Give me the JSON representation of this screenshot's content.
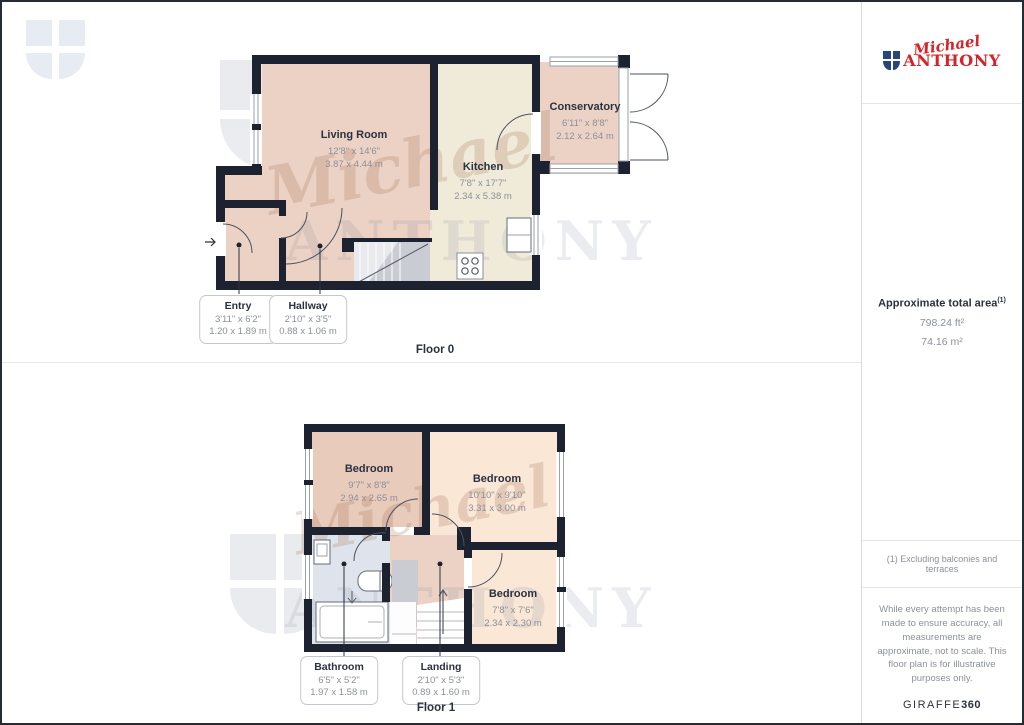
{
  "brand": {
    "script": "Michael",
    "caps": "ANTHONY"
  },
  "floors": [
    {
      "label": "Floor 0",
      "rooms": [
        {
          "name": "Living Room",
          "imperial": "12'8\" x 14'6\"",
          "metric": "3.87 x 4.44 m"
        },
        {
          "name": "Kitchen",
          "imperial": "7'8\" x 17'7\"",
          "metric": "2.34 x 5.38 m"
        },
        {
          "name": "Conservatory",
          "imperial": "6'11\" x 8'8\"",
          "metric": "2.12 x 2.64 m"
        }
      ],
      "callouts": [
        {
          "name": "Entry",
          "imperial": "3'11\" x 6'2\"",
          "metric": "1.20 x 1.89 m"
        },
        {
          "name": "Hallway",
          "imperial": "2'10\" x 3'5\"",
          "metric": "0.88 x 1.06 m"
        }
      ]
    },
    {
      "label": "Floor 1",
      "rooms": [
        {
          "name": "Bedroom",
          "imperial": "9'7\" x 8'8\"",
          "metric": "2.94 x 2.65 m"
        },
        {
          "name": "Bedroom",
          "imperial": "10'10\" x 9'10\"",
          "metric": "3.31 x 3.00 m"
        },
        {
          "name": "Bedroom",
          "imperial": "7'8\" x 7'6\"",
          "metric": "2.34 x 2.30 m"
        }
      ],
      "callouts": [
        {
          "name": "Bathroom",
          "imperial": "6'5\" x 5'2\"",
          "metric": "1.97 x 1.58 m"
        },
        {
          "name": "Landing",
          "imperial": "2'10\" x 5'3\"",
          "metric": "0.89 x 1.60 m"
        }
      ]
    }
  ],
  "sidebar": {
    "area_title": "Approximate total area",
    "area_sup": "(1)",
    "area_ft": "798.24 ft²",
    "area_m": "74.16 m²",
    "footnote": "(1) Excluding balconies and terraces",
    "disclaimer": "While every attempt has been made to ensure accuracy, all measurements are approximate, not to scale. This floor plan is for illustrative purposes only.",
    "provider": "GIRAFFE",
    "provider_suffix": "360"
  },
  "colors": {
    "wall": "#1d2230",
    "room_pink": "#ecd2c4",
    "room_cream": "#f0ead9",
    "room_peach": "#fae7d6",
    "room_warm": "#e9cbbb",
    "room_bath": "#dfe4ec",
    "stairs_gray": "#c9ccd3",
    "brand_red": "#d42429",
    "brand_navy": "#27457e",
    "text_dark": "#2b3140",
    "text_gray": "#8b909b",
    "watermark": "#e7ecf3"
  }
}
